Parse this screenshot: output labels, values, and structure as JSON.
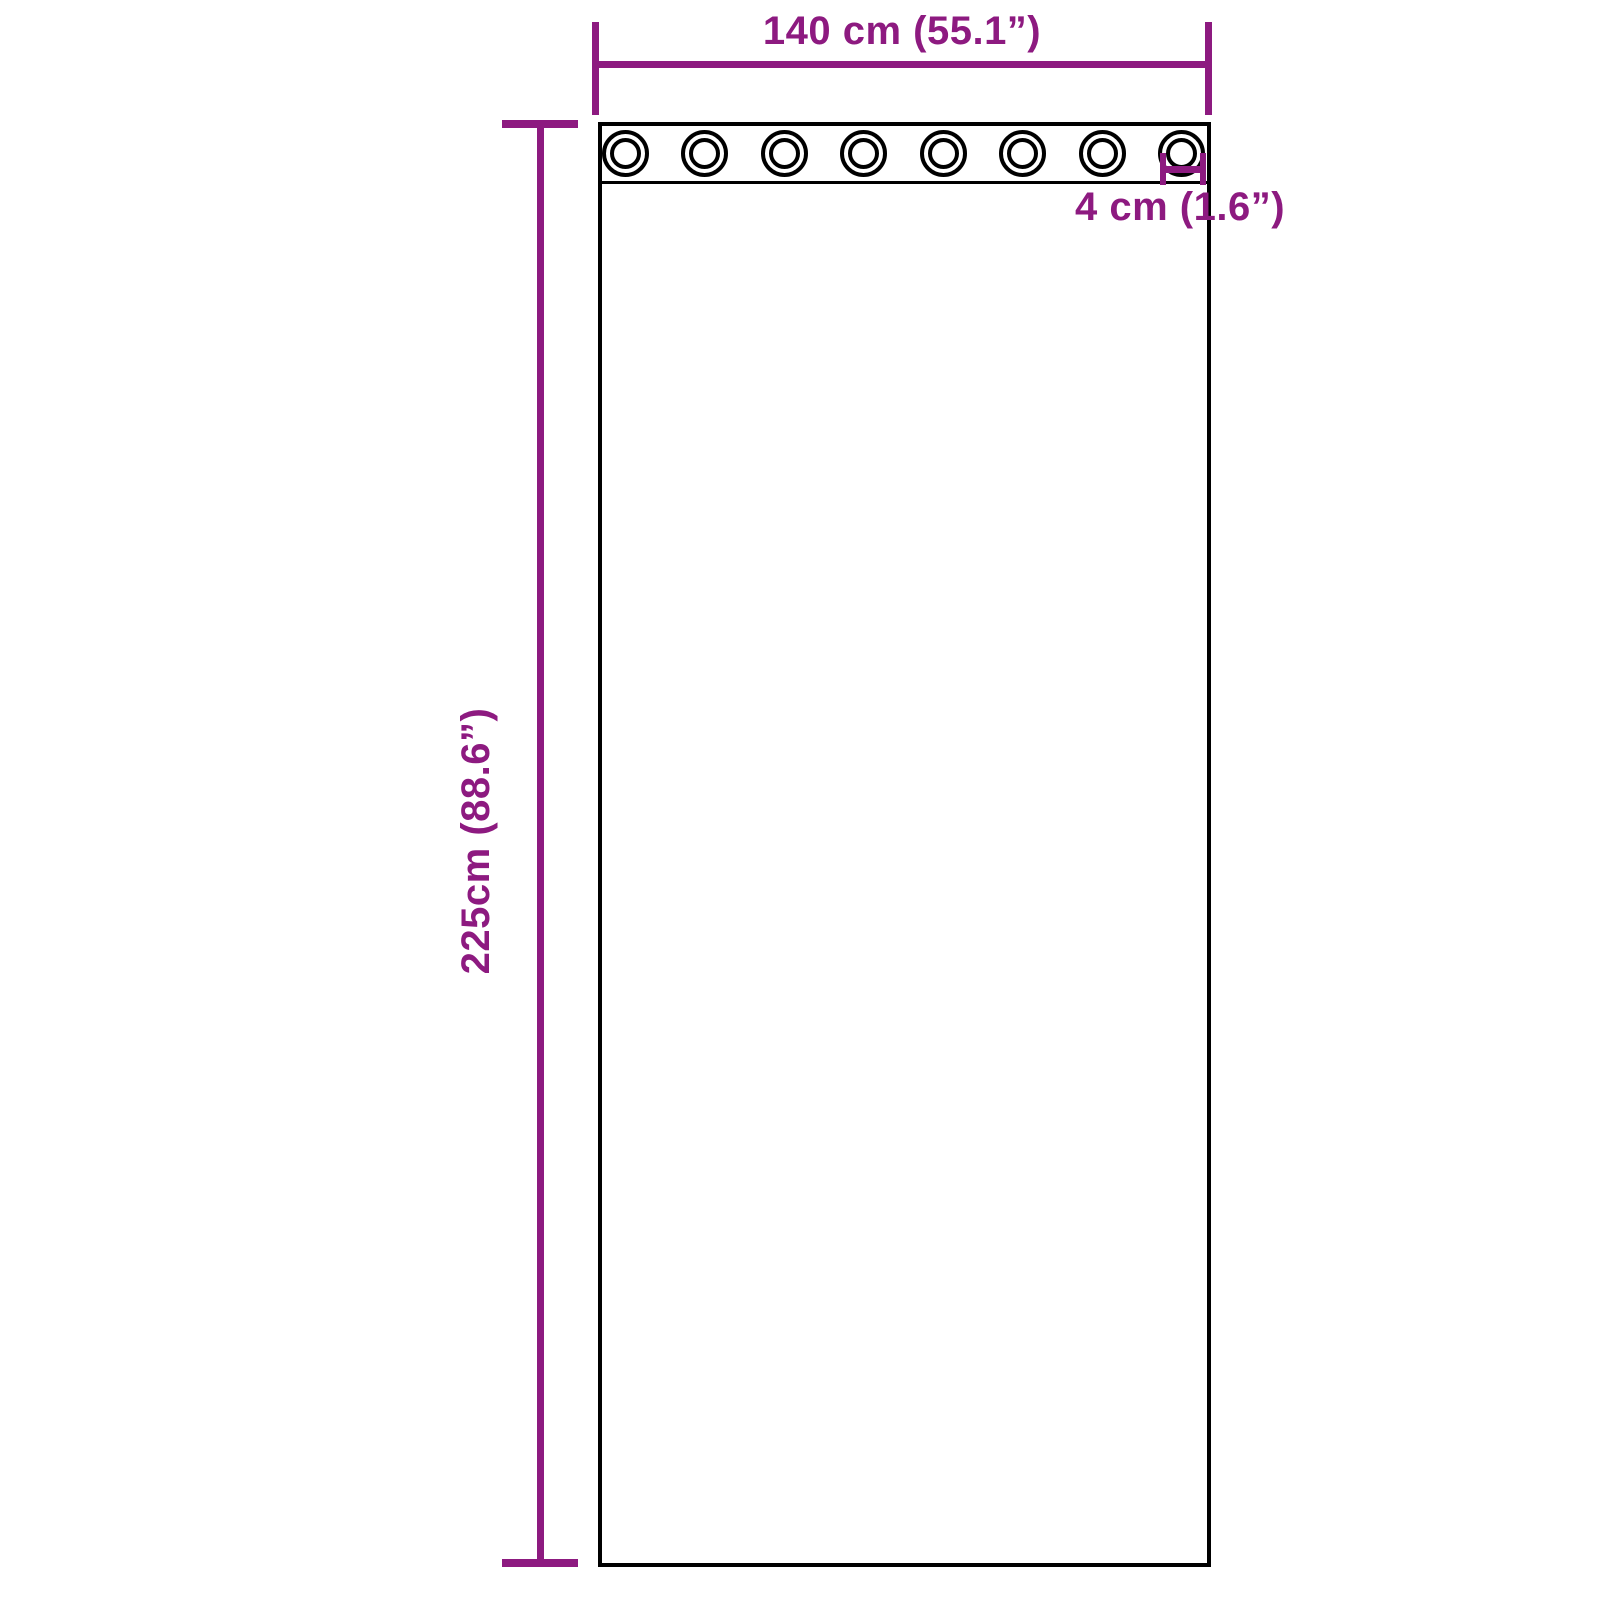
{
  "page": {
    "background": "#ffffff"
  },
  "colors": {
    "dimension_accent": "#8D1A80",
    "outline": "#000000"
  },
  "diagram": {
    "type": "product-dimension-diagram",
    "subject": "grommet-curtain-panel",
    "grommet_count": 8,
    "dimensions": {
      "width": {
        "label": "140 cm (55.1”)"
      },
      "height": {
        "label": "225cm (88.6”)"
      },
      "grommet": {
        "label": "4 cm (1.6”)"
      }
    }
  }
}
